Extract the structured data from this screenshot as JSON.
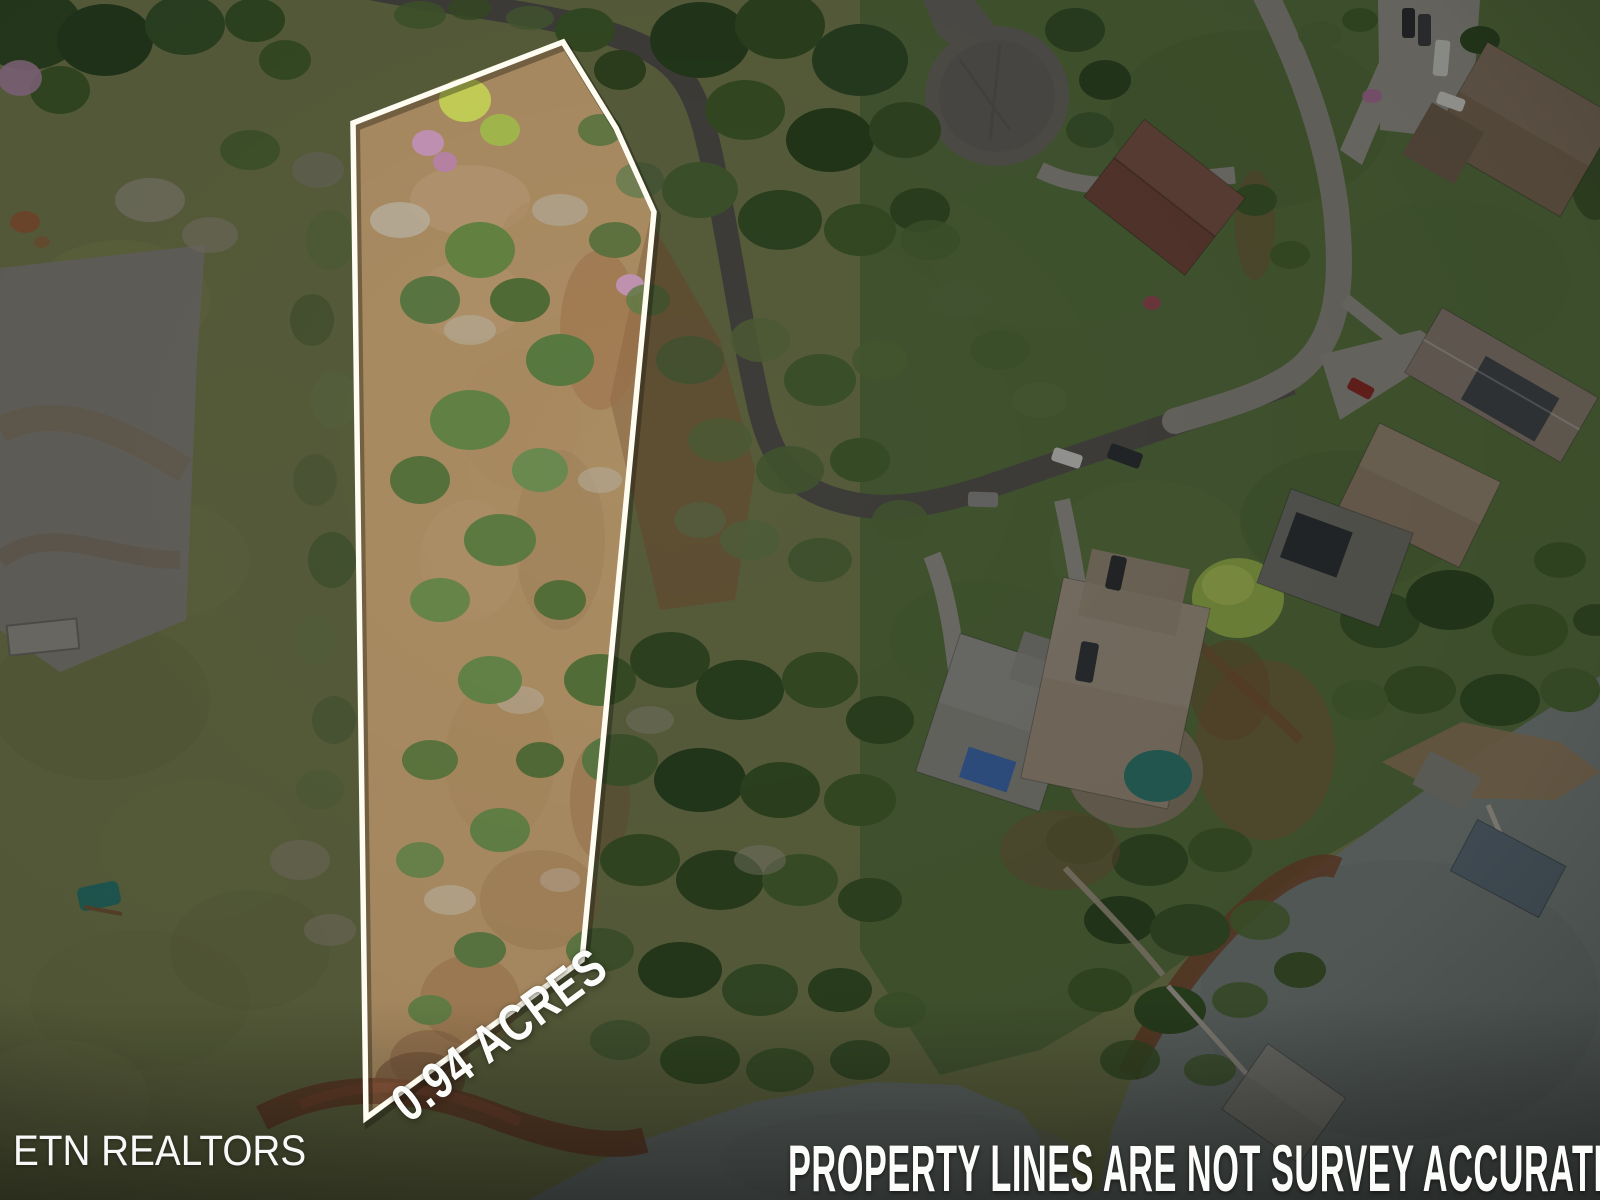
{
  "image_type": "aerial-drone-photo",
  "overlay": {
    "watermark": "ETN REALTORS",
    "lot_area_label": "0.94 ACRES",
    "disclaimer": "PROPERTY LINES ARE NOT SURVEY ACCURATE"
  },
  "colors": {
    "boundary": "#fffdf2",
    "overlay-text": "#fcfcfa",
    "grass": "#7b8351",
    "lawn": "#5b7540",
    "dirt": "#a6875d",
    "water": "#7d8682",
    "road-dark": "#56544e",
    "road-light": "#8f8c83",
    "concrete": "#98958c",
    "mud": "#7d4e31",
    "pool": "#2f7e72"
  }
}
